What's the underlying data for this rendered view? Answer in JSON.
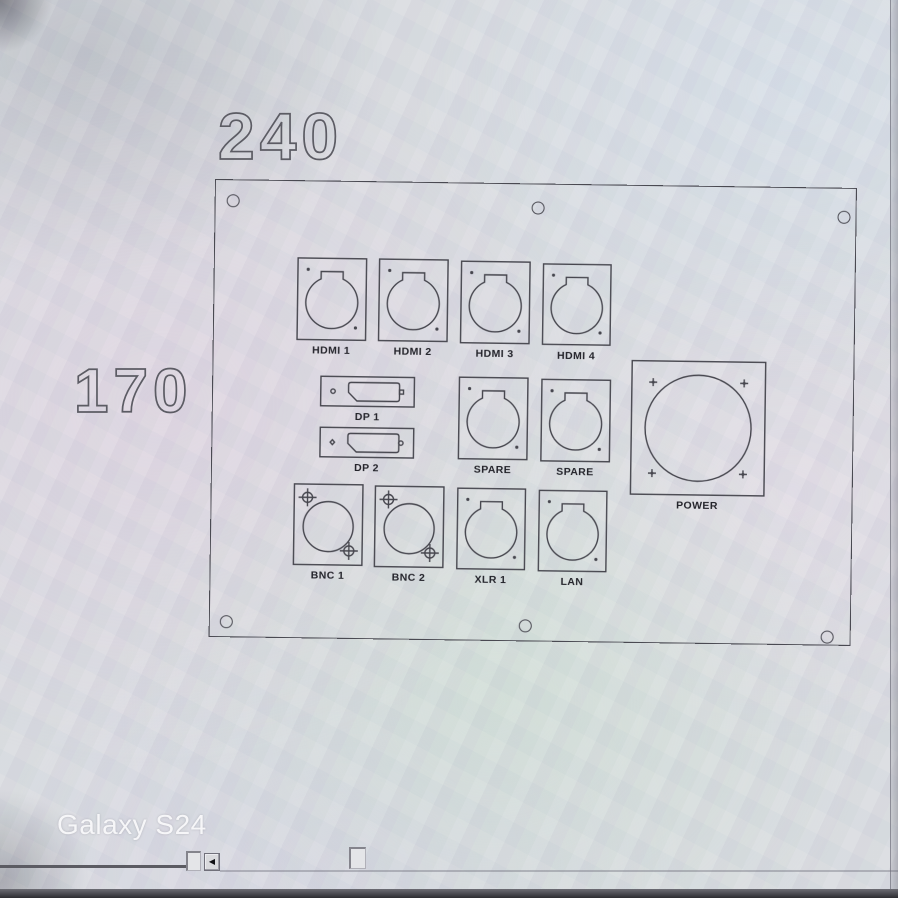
{
  "photo": {
    "watermark": "Galaxy S24"
  },
  "drawing": {
    "dimensions": {
      "width": "240",
      "height": "170"
    },
    "connectors": [
      {
        "label": "HDMI 1",
        "type": "xlr-d-cutout"
      },
      {
        "label": "HDMI 2",
        "type": "xlr-d-cutout"
      },
      {
        "label": "HDMI 3",
        "type": "xlr-d-cutout"
      },
      {
        "label": "HDMI 4",
        "type": "xlr-d-cutout"
      },
      {
        "label": "DP 1",
        "type": "displayport-cutout"
      },
      {
        "label": "DP 2",
        "type": "displayport-cutout"
      },
      {
        "label": "SPARE",
        "type": "xlr-d-cutout"
      },
      {
        "label": "SPARE",
        "type": "xlr-d-cutout"
      },
      {
        "label": "POWER",
        "type": "round-power-cutout"
      },
      {
        "label": "BNC 1",
        "type": "bnc-cutout"
      },
      {
        "label": "BNC 2",
        "type": "bnc-cutout"
      },
      {
        "label": "XLR 1",
        "type": "xlr-d-cutout"
      },
      {
        "label": "LAN",
        "type": "xlr-d-cutout"
      }
    ],
    "mounting_holes_count": 6
  },
  "ui": {
    "scrollbar": {
      "left_arrow_glyph": "◀"
    }
  },
  "colors": {
    "line": "#46464e",
    "label_text": "#24242b",
    "dimension_outline": "#5c5c64",
    "watermark_text": "#f6f6f8",
    "screen_background": "#d9dce0",
    "bottom_strip": "#2c2c31"
  }
}
